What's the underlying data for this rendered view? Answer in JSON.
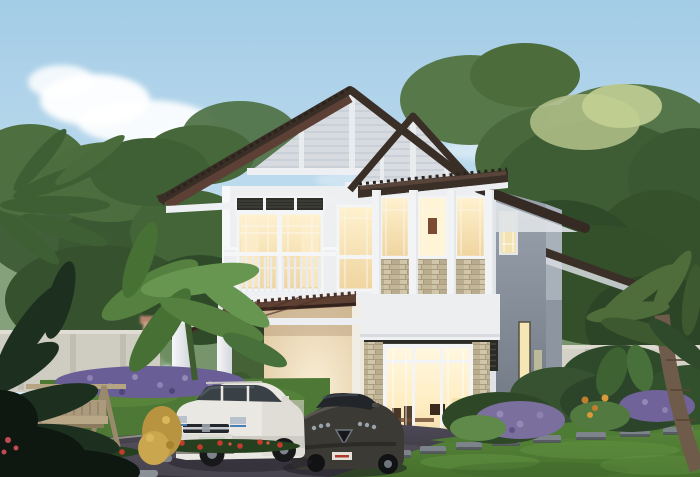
{
  "scene": {
    "type": "architectural-rendering",
    "description": "Two-story modern tropical house at dusk with warm interior lighting, gabled dark-brown hip roof, balcony, stacked-stone window accents, tiled carport with a white SUV and a dark sedan parked in front, garden swing bench, purple and red flower beds, tropical trees, compound wall, asphalt driveway and green lawn",
    "time_of_day": "dusk",
    "objects": [
      "sky",
      "clouds",
      "background-trees",
      "palm-fronds",
      "compound-wall",
      "distant-house",
      "two-story-house",
      "hip-roof",
      "gable-siding",
      "tile-awning",
      "balcony",
      "balcony-railing",
      "upper-window-block",
      "stone-accent-panels",
      "louver-transom",
      "louver-band",
      "ground-floor-window",
      "interior-dining-room",
      "carport",
      "carport-roof",
      "carport-pillars",
      "white-suv",
      "dark-sedan",
      "driveway",
      "lawn",
      "stepping-stones",
      "garden-swing-bench",
      "purple-flower-bed",
      "red-flowers",
      "banana-plants",
      "tropical-shrubs",
      "palm-trunk"
    ]
  },
  "house": {
    "stories": 2,
    "style": "modern tropical",
    "lighting": "warm interior lights on",
    "roof": "dark brown hip roof with two front-facing gables and horizontal siding",
    "facade_features": [
      "white walls",
      "tan stacked-stone accents",
      "dark louver panels",
      "white balcony railing",
      "tiled window awning"
    ]
  },
  "vehicles": [
    {
      "type": "SUV",
      "color": "white",
      "position": "under carport, left"
    },
    {
      "type": "sedan",
      "color": "dark charcoal",
      "position": "driveway, right of SUV"
    }
  ],
  "palette": {
    "sky_top": "#a3cce6",
    "sky_mid": "#c6e0f0",
    "sky_horizon": "#e0eff7",
    "cloud_white": "#ffffff",
    "foliage_far": "#7d9a6e",
    "foliage_dark": "#33502b",
    "foliage_mid": "#446537",
    "foliage_light": "#5d8045",
    "foliage_yellow": "#b7c48b",
    "roof_dark": "#3a2f27",
    "roof_tile_maroon": "#5c4035",
    "carport_tile": "#5f4134",
    "gable_siding": "#d7dbe0",
    "trim_white": "#f2f4f6",
    "wall_white": "#edeff1",
    "side_wall_gray": "#9aa2ad",
    "stone_tan": "#c8bc9e",
    "louver_dark": "#2b2b26",
    "window_warm": "#f6e3ae",
    "window_bright": "#fff4d6",
    "carport_cream": "#f3e6c8",
    "compound_wall": "#d4d1c7",
    "lawn_green": "#5c8b3d",
    "lawn_dark": "#477031",
    "driveway": "#4e4956",
    "flower_purple": "#6a5e96",
    "flower_red": "#c23b2c",
    "bench_wood": "#b5a583",
    "suv_white": "#e9e8e2",
    "sedan_dark": "#3b3a35",
    "palm_trunk": "#6e5b49",
    "stepping_stone": "#7d838b",
    "headlight_blue": "#4a7fb5"
  }
}
